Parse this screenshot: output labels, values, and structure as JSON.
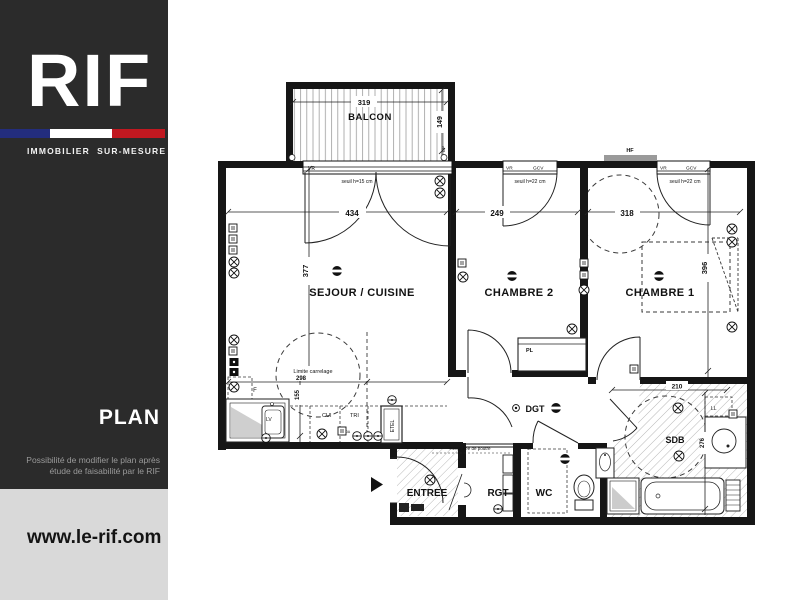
{
  "sidebar": {
    "brand": "RIF",
    "tagline": "IMMOBILIER  SUR-MESURE",
    "section_label": "PLAN",
    "note_line1": "Possibilité de modifier le plan après",
    "note_line2": "étude de faisabilité par le RIF",
    "website": "www.le-rif.com",
    "colors": {
      "panel": "#2b2b2b",
      "footer": "#d9d9d9",
      "flag_blue": "#232d7d",
      "flag_white": "#ffffff",
      "flag_red": "#c01820"
    }
  },
  "plan": {
    "rooms": {
      "balcon": "BALCON",
      "sejour": "SEJOUR / CUISINE",
      "chambre2": "CHAMBRE 2",
      "chambre1": "CHAMBRE 1",
      "entree": "ENTREE",
      "rgt": "RGT",
      "wc": "WC",
      "sdb": "SDB",
      "dgt": "DGT",
      "placard": "PL"
    },
    "dimensions": {
      "balcon_width": "319",
      "balcon_depth": "149",
      "sejour_width": "434",
      "chambre2_width": "249",
      "chambre1_width": "318",
      "sejour_depth": "377",
      "chambre1_depth": "396",
      "cuisine_depth": "155",
      "carrelage_width": "298",
      "sdb_width": "210",
      "sdb_depth": "276"
    },
    "annotations": {
      "seuil_15": "seuil h=15 cm",
      "seuil_22": "seuil h=22 cm",
      "limite_carrelage": "Limite carrelage",
      "retombee": "Retombée de poutre",
      "vr": "VR",
      "gcv": "GCV",
      "hf": "HF",
      "ep": "EP",
      "ll": "LL",
      "lv": "LV",
      "cui": "CUI",
      "tri": "TRI",
      "etel": "ETEL",
      "frigo": "F",
      "amp": "20A"
    }
  }
}
